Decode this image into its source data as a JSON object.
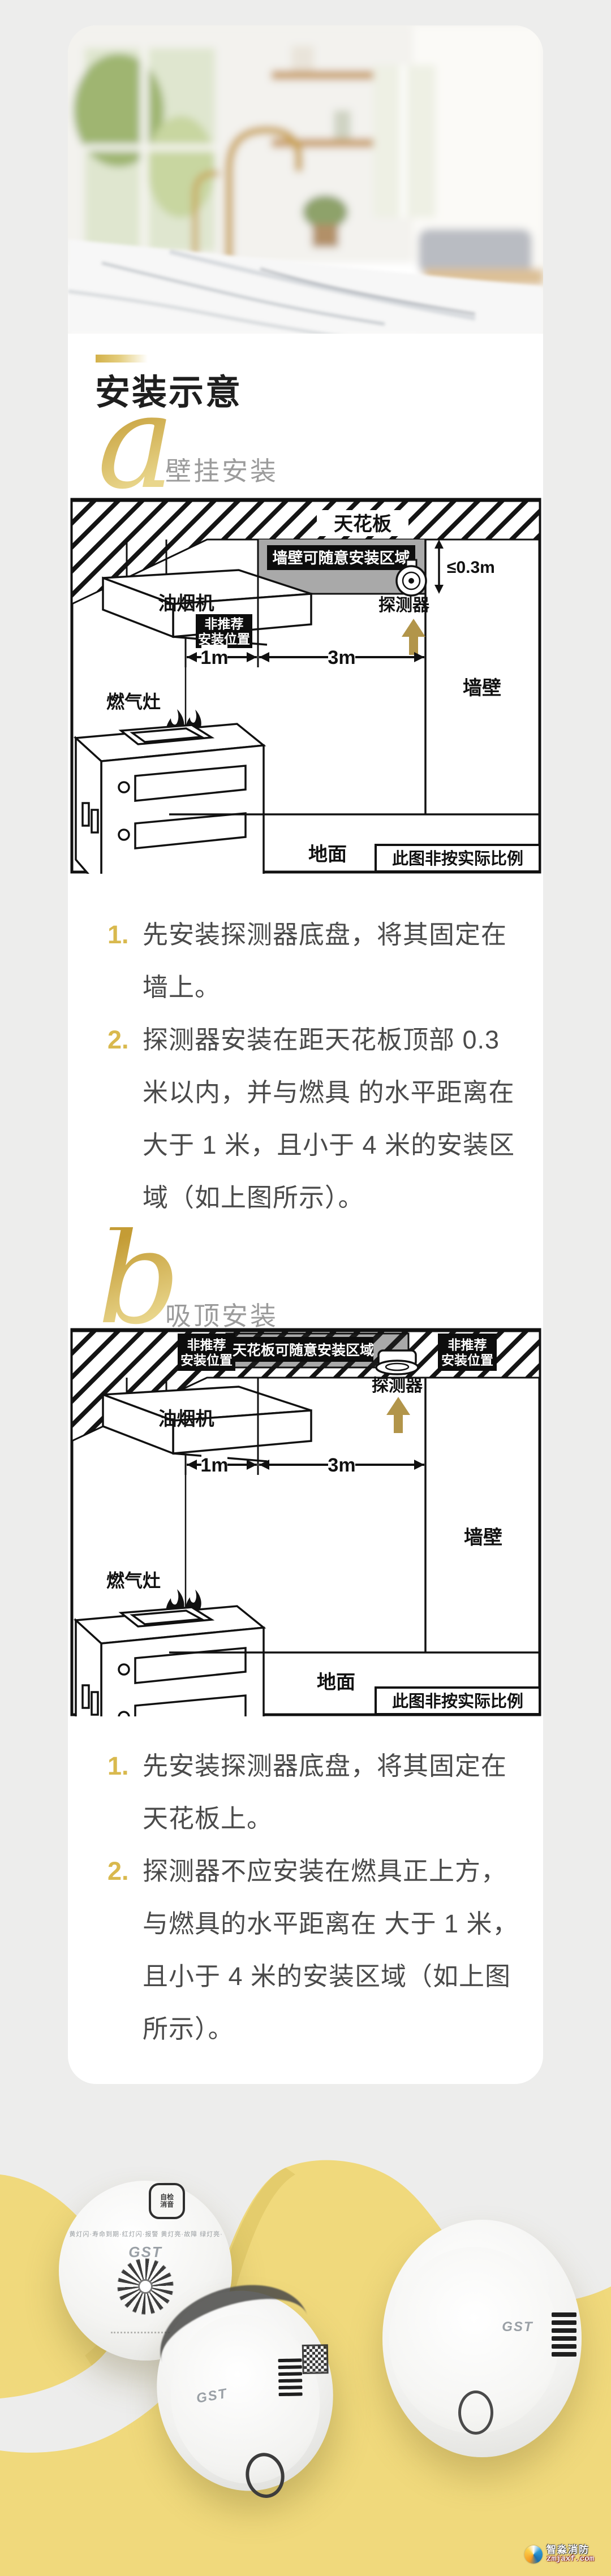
{
  "colors": {
    "accent_gold": "#d2b14d",
    "arrow_gold": "#b2954a",
    "promo_yellow": "#f0d97c",
    "promo_yellow_dark": "#e2c96a",
    "text_dark": "#4a4a4a"
  },
  "header": {
    "title": "安装示意"
  },
  "section_a": {
    "letter": "a",
    "label": "壁挂安装",
    "diagram": {
      "ceiling": "天花板",
      "zone_label": "墙壁可随意安装区域",
      "distance": "≤0.3m",
      "detector": "探测器",
      "hood": "油烟机",
      "not_recommended_line1": "非推荐",
      "not_recommended_line2": "安装位置",
      "dim1": "1m",
      "dim2": "3m",
      "wall": "墙壁",
      "stove": "燃气灶",
      "floor": "地面",
      "scale_note": "此图非按实际比例"
    },
    "steps": [
      {
        "num": "1.",
        "text": "先安装探测器底盘，将其固定在墙上。"
      },
      {
        "num": "2.",
        "text": "探测器安装在距天花板顶部 0.3 米以内，并与燃具 的水平距离在大于 1 米，且小于 4 米的安装区域（如上图所示）。"
      }
    ]
  },
  "section_b": {
    "letter": "b",
    "label": "吸顶安装",
    "diagram": {
      "not_recommended_line1": "非推荐",
      "not_recommended_line2": "安装位置",
      "zone_label": "天花板可随意安装区域",
      "detector": "探测器",
      "hood": "油烟机",
      "dim1": "1m",
      "dim2": "3m",
      "wall": "墙壁",
      "stove": "燃气灶",
      "floor": "地面",
      "scale_note": "此图非按实际比例"
    },
    "steps": [
      {
        "num": "1.",
        "text": "先安装探测器底盘，将其固定在天花板上。"
      },
      {
        "num": "2.",
        "text": "探测器不应安装在燃具正上方，与燃具的水平距离在 大于 1 米，且小于 4 米的安装区域（如上图所示）。"
      }
    ]
  },
  "products": {
    "brand": "GST",
    "left_button_line1": "自检",
    "left_button_line2": "消音",
    "left_ring_text": "黄灯闪·寿命到期·红灯闪·报警 黄灯亮·故障 绿灯亮·正常"
  },
  "watermark": {
    "name": "智淼消防",
    "site": "zmjaxf.com"
  }
}
